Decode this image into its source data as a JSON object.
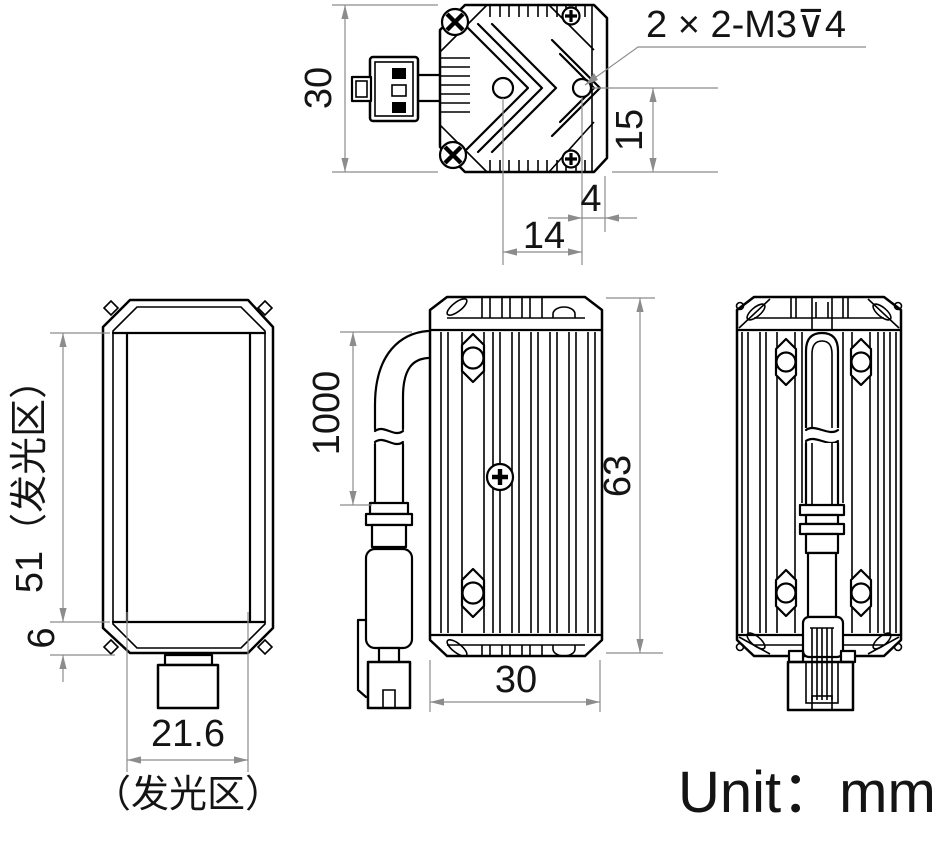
{
  "unit_label": "Unit：mm",
  "dims": {
    "top": {
      "height": "30",
      "thread_note": "2 × 2-M3⊽4",
      "hole_to_bottom": "15",
      "hole_to_edge": "4",
      "hole_spacing": "14"
    },
    "front": {
      "emitting_height": "51（发光区）",
      "bottom_band": "6",
      "emitting_width": "21.6",
      "emitting_area": "（发光区）"
    },
    "side": {
      "cable_length": "1000",
      "body_height": "63",
      "body_width": "30"
    }
  },
  "colors": {
    "outline": "#000000",
    "dimension": "#8c8c8c",
    "text": "#141414",
    "background": "#ffffff"
  }
}
